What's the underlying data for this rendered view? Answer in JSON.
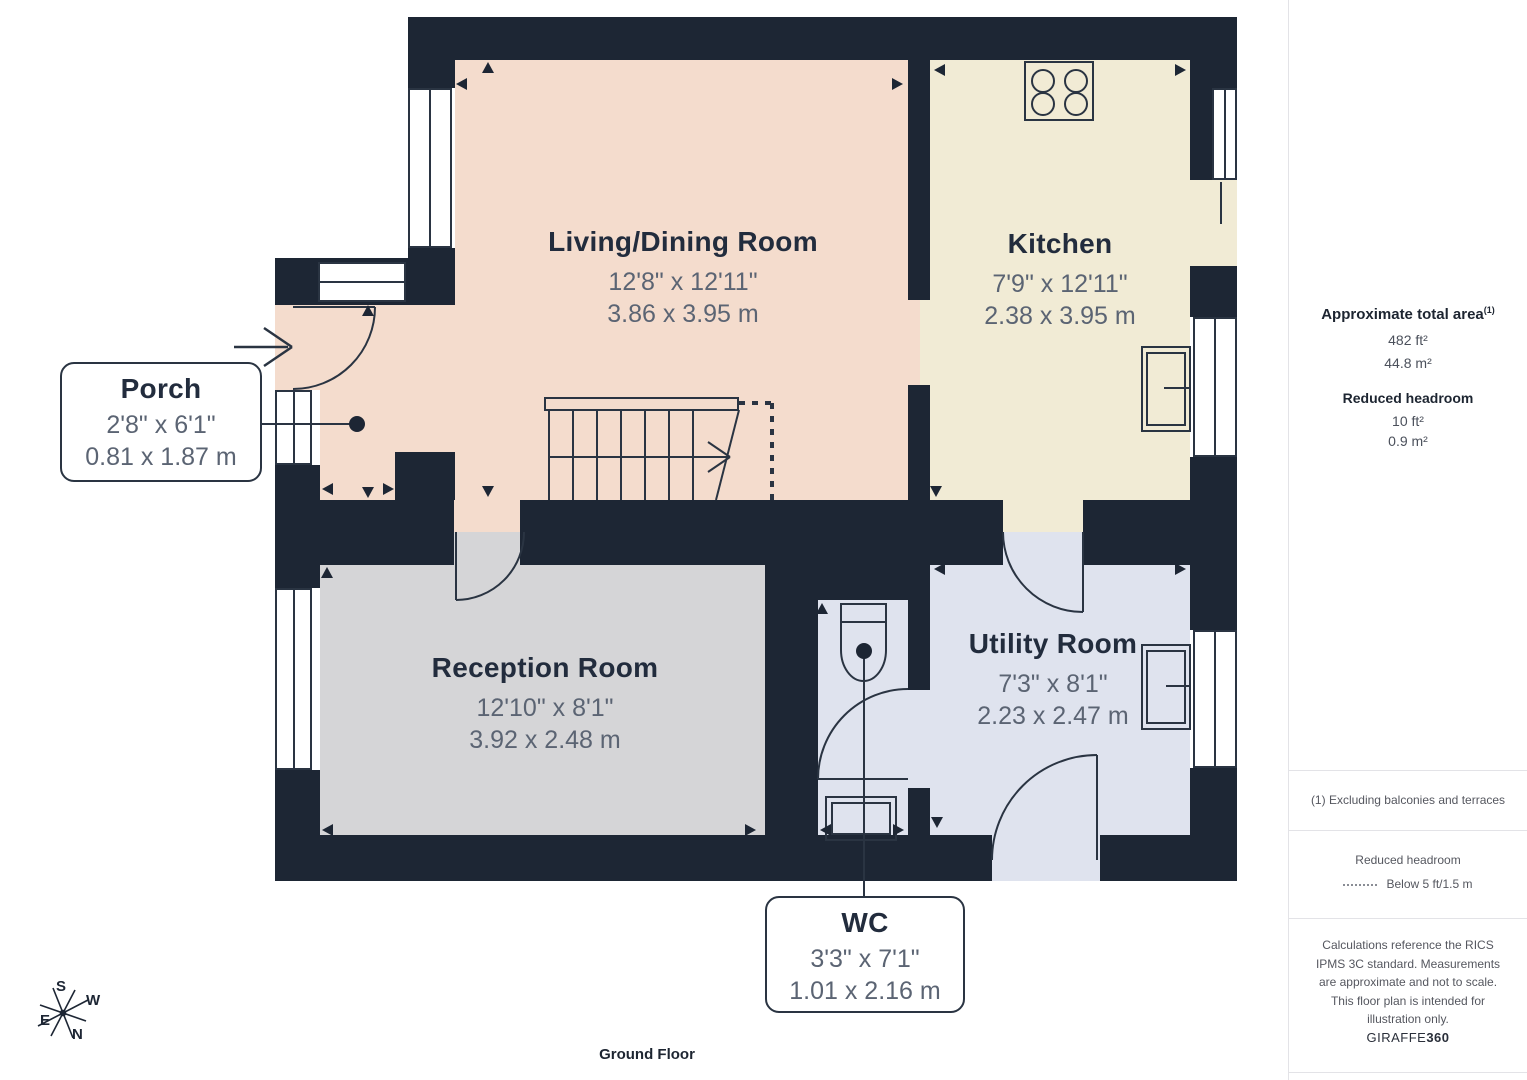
{
  "floor_label": "Ground Floor",
  "rooms": {
    "living": {
      "name": "Living/Dining Room",
      "dims_imperial": "12'8\" x 12'11\"",
      "dims_metric": "3.86 x 3.95 m"
    },
    "kitchen": {
      "name": "Kitchen",
      "dims_imperial": "7'9\" x 12'11\"",
      "dims_metric": "2.38 x 3.95 m"
    },
    "reception": {
      "name": "Reception Room",
      "dims_imperial": "12'10\" x 8'1\"",
      "dims_metric": "3.92 x 2.48 m"
    },
    "utility": {
      "name": "Utility Room",
      "dims_imperial": "7'3\" x 8'1\"",
      "dims_metric": "2.23 x 2.47 m"
    },
    "porch": {
      "name": "Porch",
      "dims_imperial": "2'8\" x 6'1\"",
      "dims_metric": "0.81 x 1.87 m"
    },
    "wc": {
      "name": "WC",
      "dims_imperial": "3'3\" x 7'1\"",
      "dims_metric": "1.01 x 2.16 m"
    }
  },
  "sidebar": {
    "total_area_label": "Approximate total area",
    "total_area_superscript": "(1)",
    "total_area_ft": "482 ft²",
    "total_area_m": "44.8 m²",
    "reduced_headroom_label": "Reduced headroom",
    "reduced_headroom_ft": "10 ft²",
    "reduced_headroom_m": "0.9 m²",
    "footnote": "(1) Excluding balconies and terraces",
    "legend_title": "Reduced headroom",
    "legend_value": "Below 5 ft/1.5 m",
    "disclaimer": "Calculations reference the RICS IPMS 3C standard. Measurements are approximate and not to scale. This floor plan is intended for illustration only.",
    "brand_regular": "GIRAFFE",
    "brand_bold": "360"
  },
  "compass": {
    "n": "N",
    "s": "S",
    "e": "E",
    "w": "W"
  },
  "colors": {
    "wall": "#1d2634",
    "living_fill": "#f4dccd",
    "kitchen_fill": "#f1ebd5",
    "reception_fill": "#d5d5d7",
    "utility_fill": "#dfe3ee",
    "line": "#2a3442"
  }
}
